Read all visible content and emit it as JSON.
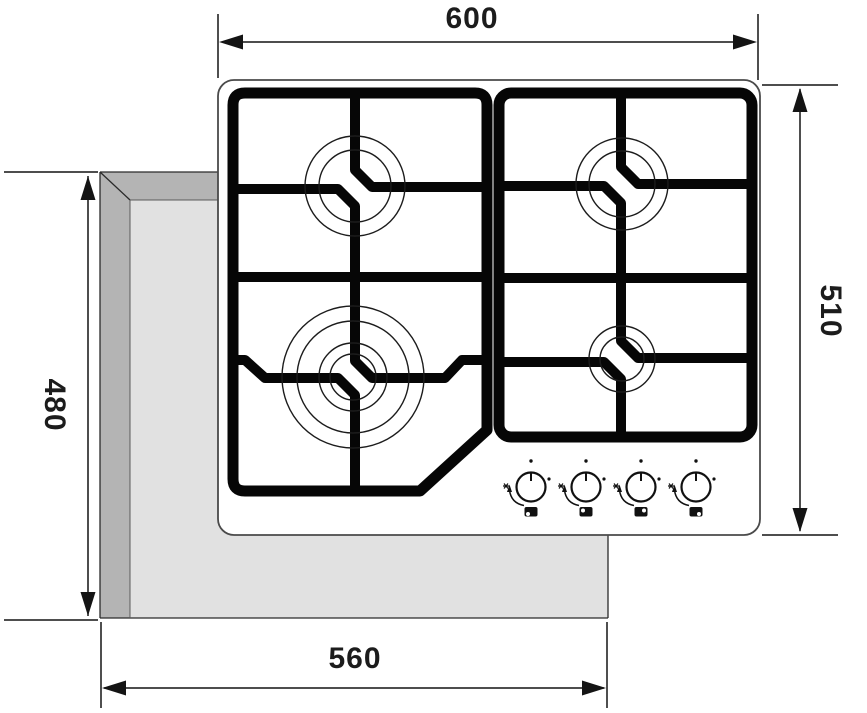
{
  "page": {
    "type": "installation-dimension-drawing",
    "subject": "built-in 4-burner gas hob, top view with worktop cutout"
  },
  "dimensions": {
    "hob_width": "600",
    "hob_depth": "510",
    "cutout_depth": "480",
    "cutout_width": "560"
  },
  "colors": {
    "line": "#141414",
    "pan_support": "#060606",
    "cutout_shadow": "#b4b4b4",
    "cutout_fill": "#e1e1e1",
    "hob_surface": "#ffffff",
    "background": "#ffffff"
  },
  "hob": {
    "burners": [
      {
        "name": "burner-rear-left",
        "rings": 2
      },
      {
        "name": "burner-rear-right",
        "rings": 2
      },
      {
        "name": "burner-front-left-wok",
        "rings": 4
      },
      {
        "name": "burner-front-right-aux",
        "rings": 2
      }
    ],
    "knobs": [
      {
        "name": "control-knob-1",
        "icons": [
          "pointer-mark-icon",
          "off-dot-icon",
          "flame-dot-icon",
          "spark-icon",
          "rotate-arrow-icon",
          "burner-position-icon-front-left"
        ]
      },
      {
        "name": "control-knob-2",
        "icons": [
          "pointer-mark-icon",
          "off-dot-icon",
          "flame-dot-icon",
          "spark-icon",
          "rotate-arrow-icon",
          "burner-position-icon-rear-left"
        ]
      },
      {
        "name": "control-knob-3",
        "icons": [
          "pointer-mark-icon",
          "off-dot-icon",
          "flame-dot-icon",
          "spark-icon",
          "rotate-arrow-icon",
          "burner-position-icon-rear-right"
        ]
      },
      {
        "name": "control-knob-4",
        "icons": [
          "pointer-mark-icon",
          "off-dot-icon",
          "flame-dot-icon",
          "spark-icon",
          "rotate-arrow-icon",
          "burner-position-icon-front-right"
        ]
      }
    ]
  }
}
